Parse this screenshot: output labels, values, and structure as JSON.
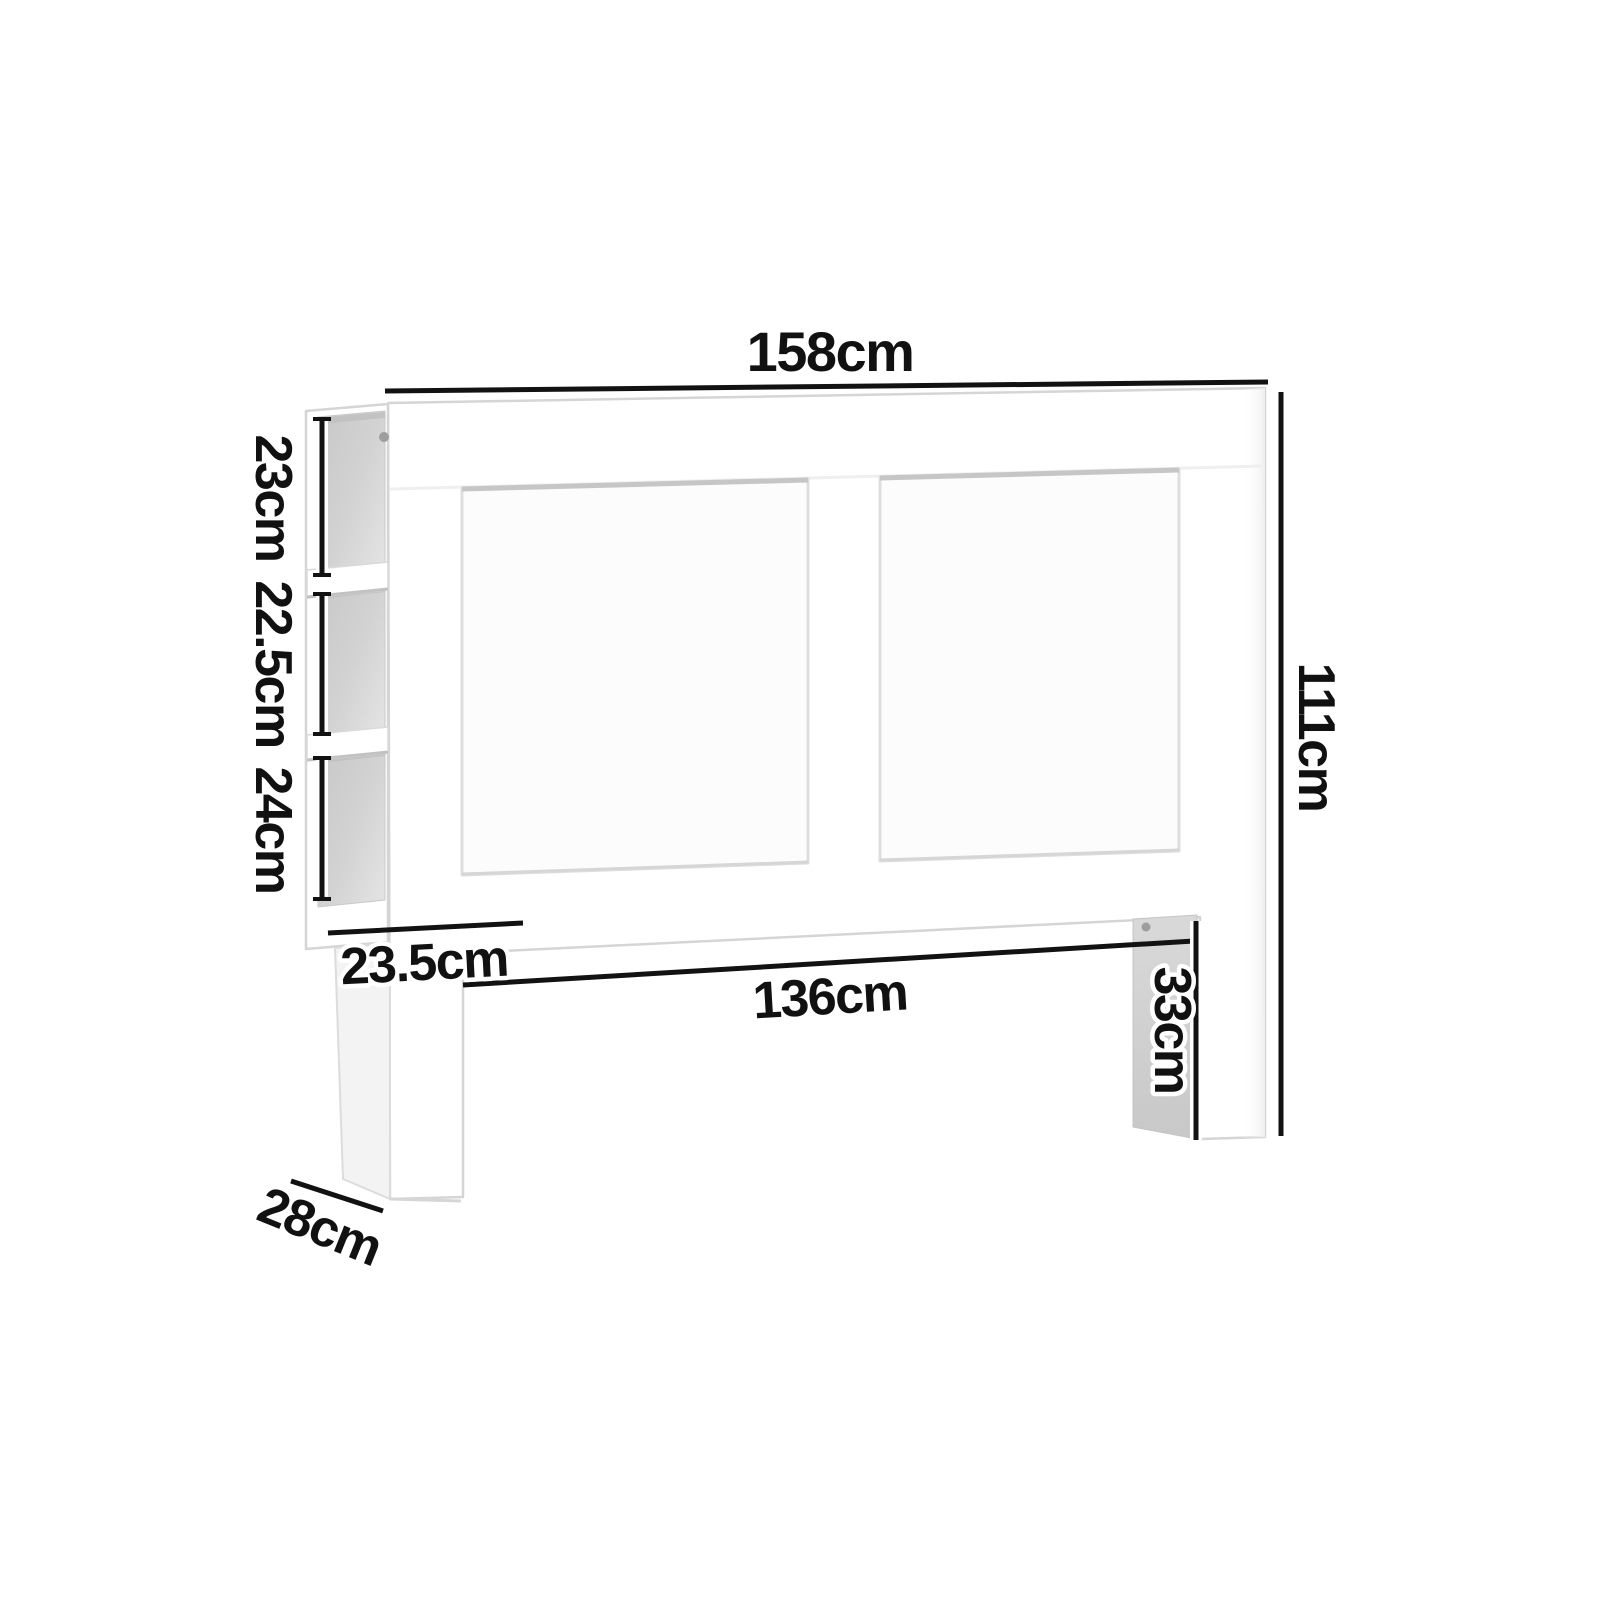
{
  "diagram": {
    "kind": "furniture-dimension-diagram",
    "labels": {
      "total_width": "158cm",
      "total_height": "111cm",
      "cubby_top": "23cm",
      "cubby_middle": "22.5cm",
      "cubby_bottom": "24cm",
      "shelf_depth": "23.5cm",
      "inner_width": "136cm",
      "leg_height": "33cm",
      "base_depth": "28cm"
    },
    "colors": {
      "background": "#ffffff",
      "furniture": "#ffffff",
      "edge": "#d5d5d5",
      "cubby_dark": "#c8c8c8",
      "cubby_light": "#e2e2e2",
      "leg_inner_face_top": "#d9d9d9",
      "leg_inner_face_bottom": "#c8c8c8",
      "dimension_line": "#121212",
      "label_text": "#111111"
    }
  }
}
